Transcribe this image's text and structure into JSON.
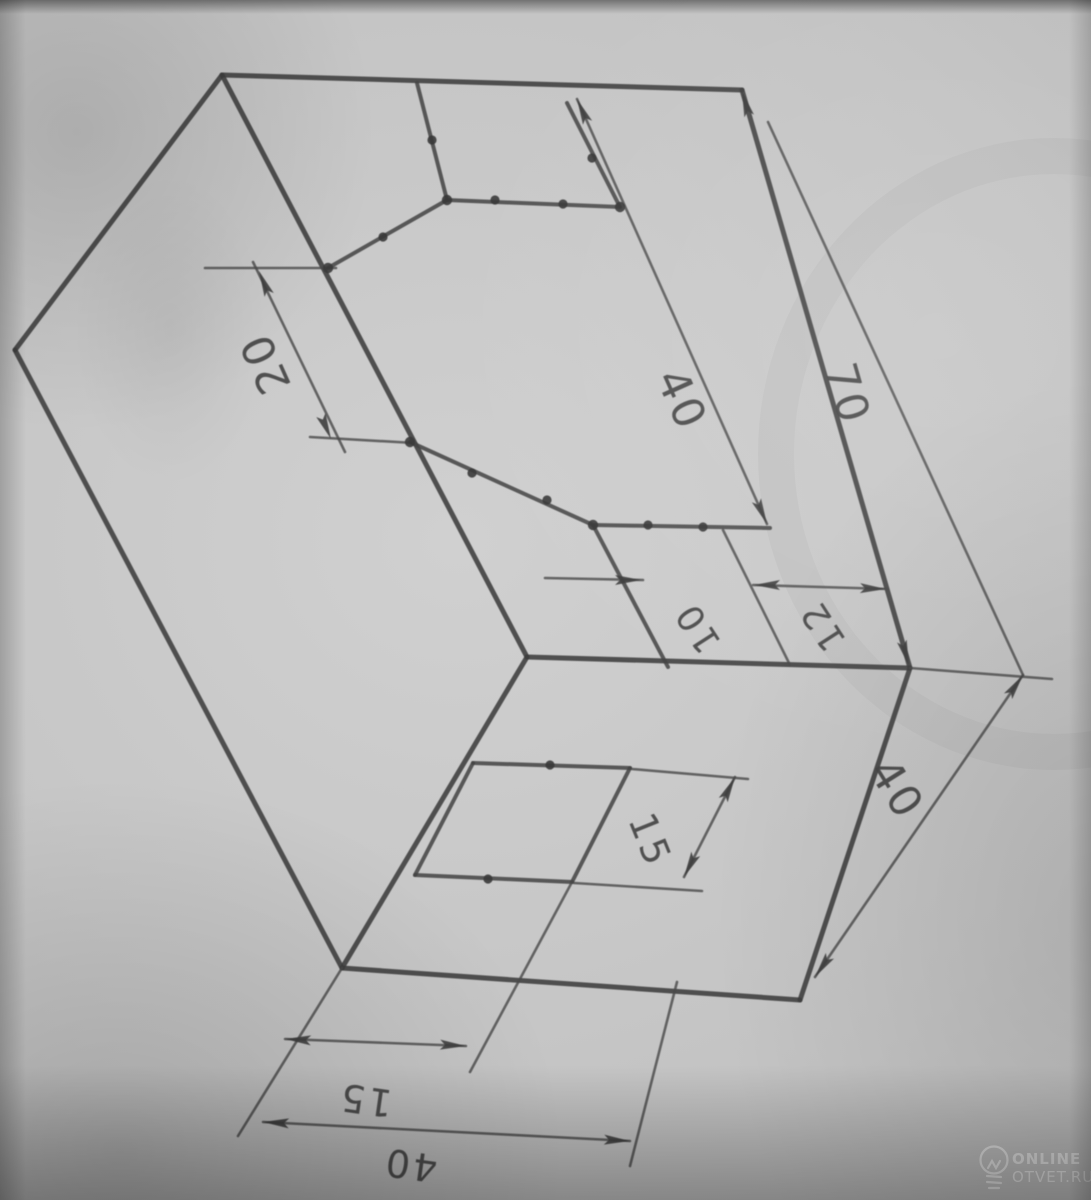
{
  "drawing": {
    "dim_labels": {
      "groove_width": "20",
      "groove_length": "40",
      "total_length": "70",
      "step_small": "10",
      "step_large": "12",
      "front_slot_height": "15",
      "box_height": "40",
      "bottom_offset": "15",
      "bottom_width": "40"
    },
    "watermark": {
      "brand_top": "ONLINE",
      "brand_bottom": "OTVET.RU"
    }
  }
}
